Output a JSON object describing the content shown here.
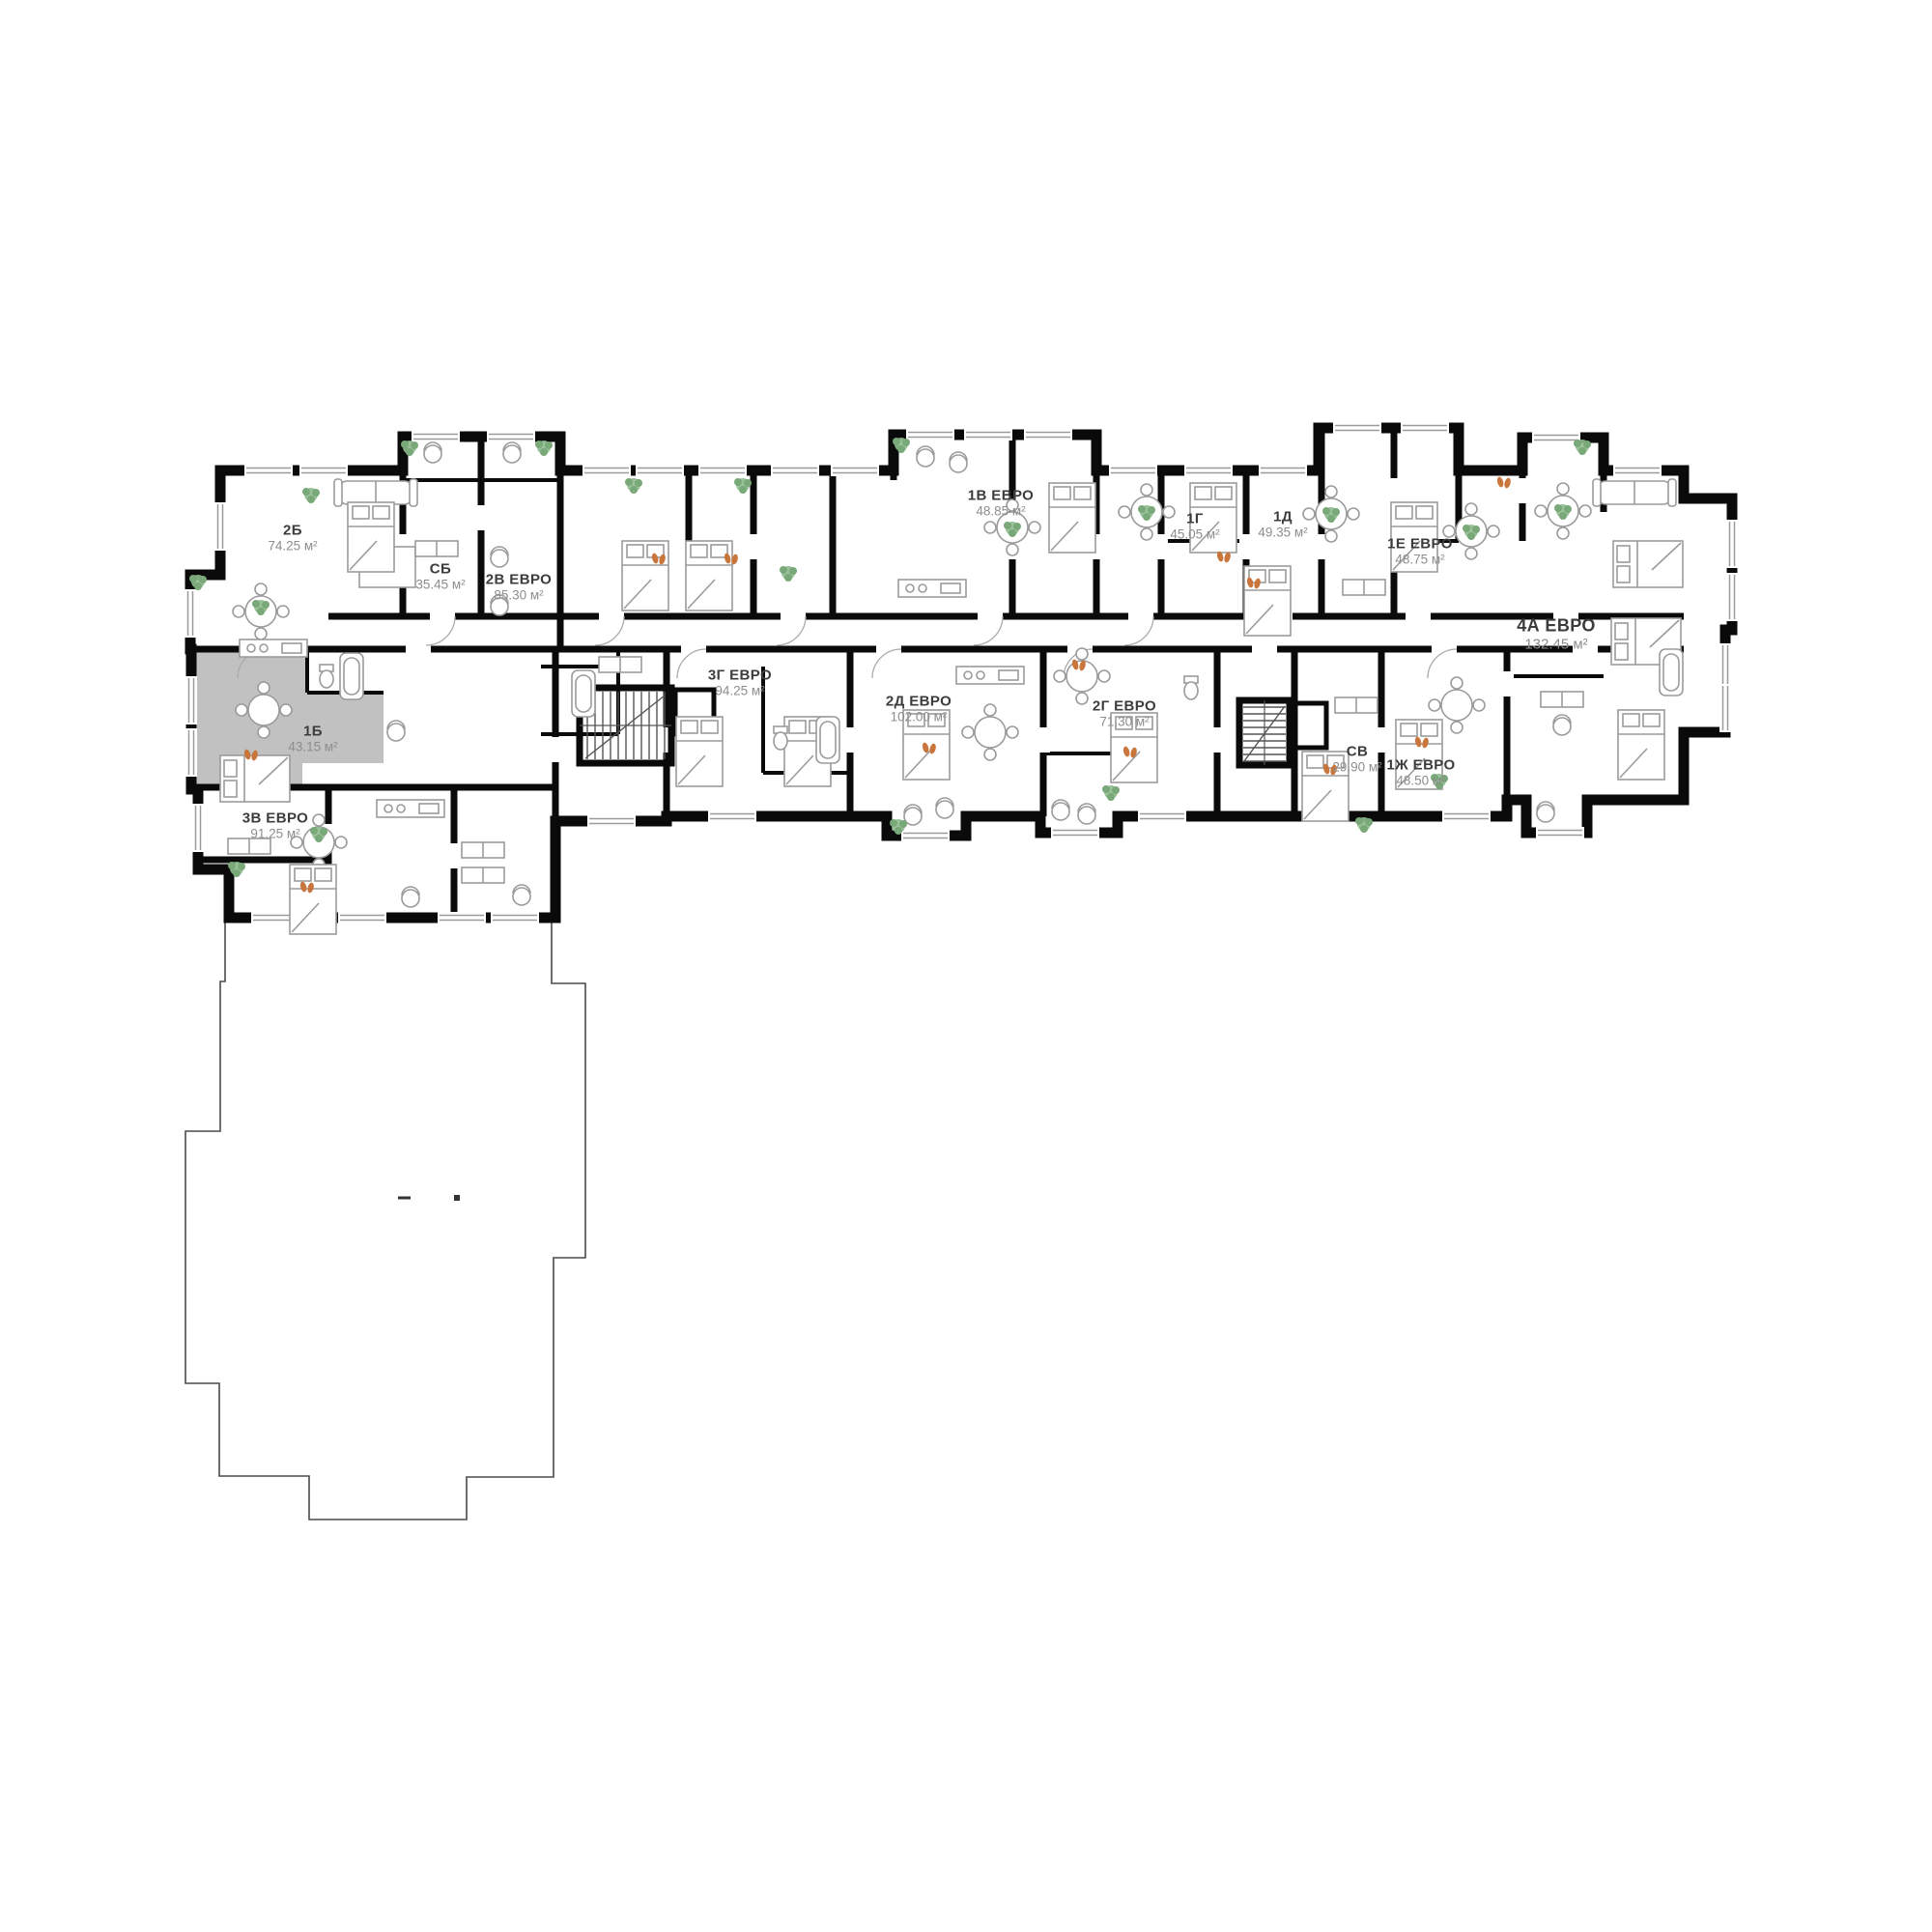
{
  "plan": {
    "units": [
      {
        "id": "2b",
        "name": "2Б",
        "area": "74.25 м²",
        "highlighted": false
      },
      {
        "id": "sb",
        "name": "СБ",
        "area": "35.45 м²",
        "highlighted": false
      },
      {
        "id": "2v-evro",
        "name": "2В ЕВРО",
        "area": "85.30 м²",
        "highlighted": false
      },
      {
        "id": "3g-evro",
        "name": "3Г ЕВРО",
        "area": "94.25 м²",
        "highlighted": false
      },
      {
        "id": "1v-evro",
        "name": "1В ЕВРО",
        "area": "48.85 м²",
        "highlighted": false
      },
      {
        "id": "1g",
        "name": "1Г",
        "area": "45.05 м²",
        "highlighted": false
      },
      {
        "id": "1d",
        "name": "1Д",
        "area": "49.35 м²",
        "highlighted": false
      },
      {
        "id": "1e-evro",
        "name": "1Е ЕВРО",
        "area": "48.75 м²",
        "highlighted": false
      },
      {
        "id": "4a-evro",
        "name": "4А ЕВРО",
        "area": "132.45 м²",
        "highlighted": false
      },
      {
        "id": "2d-evro",
        "name": "2Д ЕВРО",
        "area": "102.00 м²",
        "highlighted": false
      },
      {
        "id": "2g-evro",
        "name": "2Г ЕВРО",
        "area": "71.30 м²",
        "highlighted": false
      },
      {
        "id": "sv",
        "name": "СВ",
        "area": "29.90 м²",
        "highlighted": false
      },
      {
        "id": "1zh-evro",
        "name": "1Ж ЕВРО",
        "area": "48.50 м²",
        "highlighted": false
      },
      {
        "id": "1b",
        "name": "1Б",
        "area": "43.15 м²",
        "highlighted": true
      },
      {
        "id": "3v-evro",
        "name": "3В ЕВРО",
        "area": "91.25 м²",
        "highlighted": false
      }
    ],
    "colors": {
      "wall": "#0a0a0a",
      "highlight_fill": "#c1c1c1",
      "furniture": "#9b9b9b",
      "plant": "#83ad7e",
      "accent": "#c9763d",
      "label_name": "#3c3c3c",
      "label_area": "#8d8d8d",
      "terrace_line": "#4a4a4a"
    }
  }
}
